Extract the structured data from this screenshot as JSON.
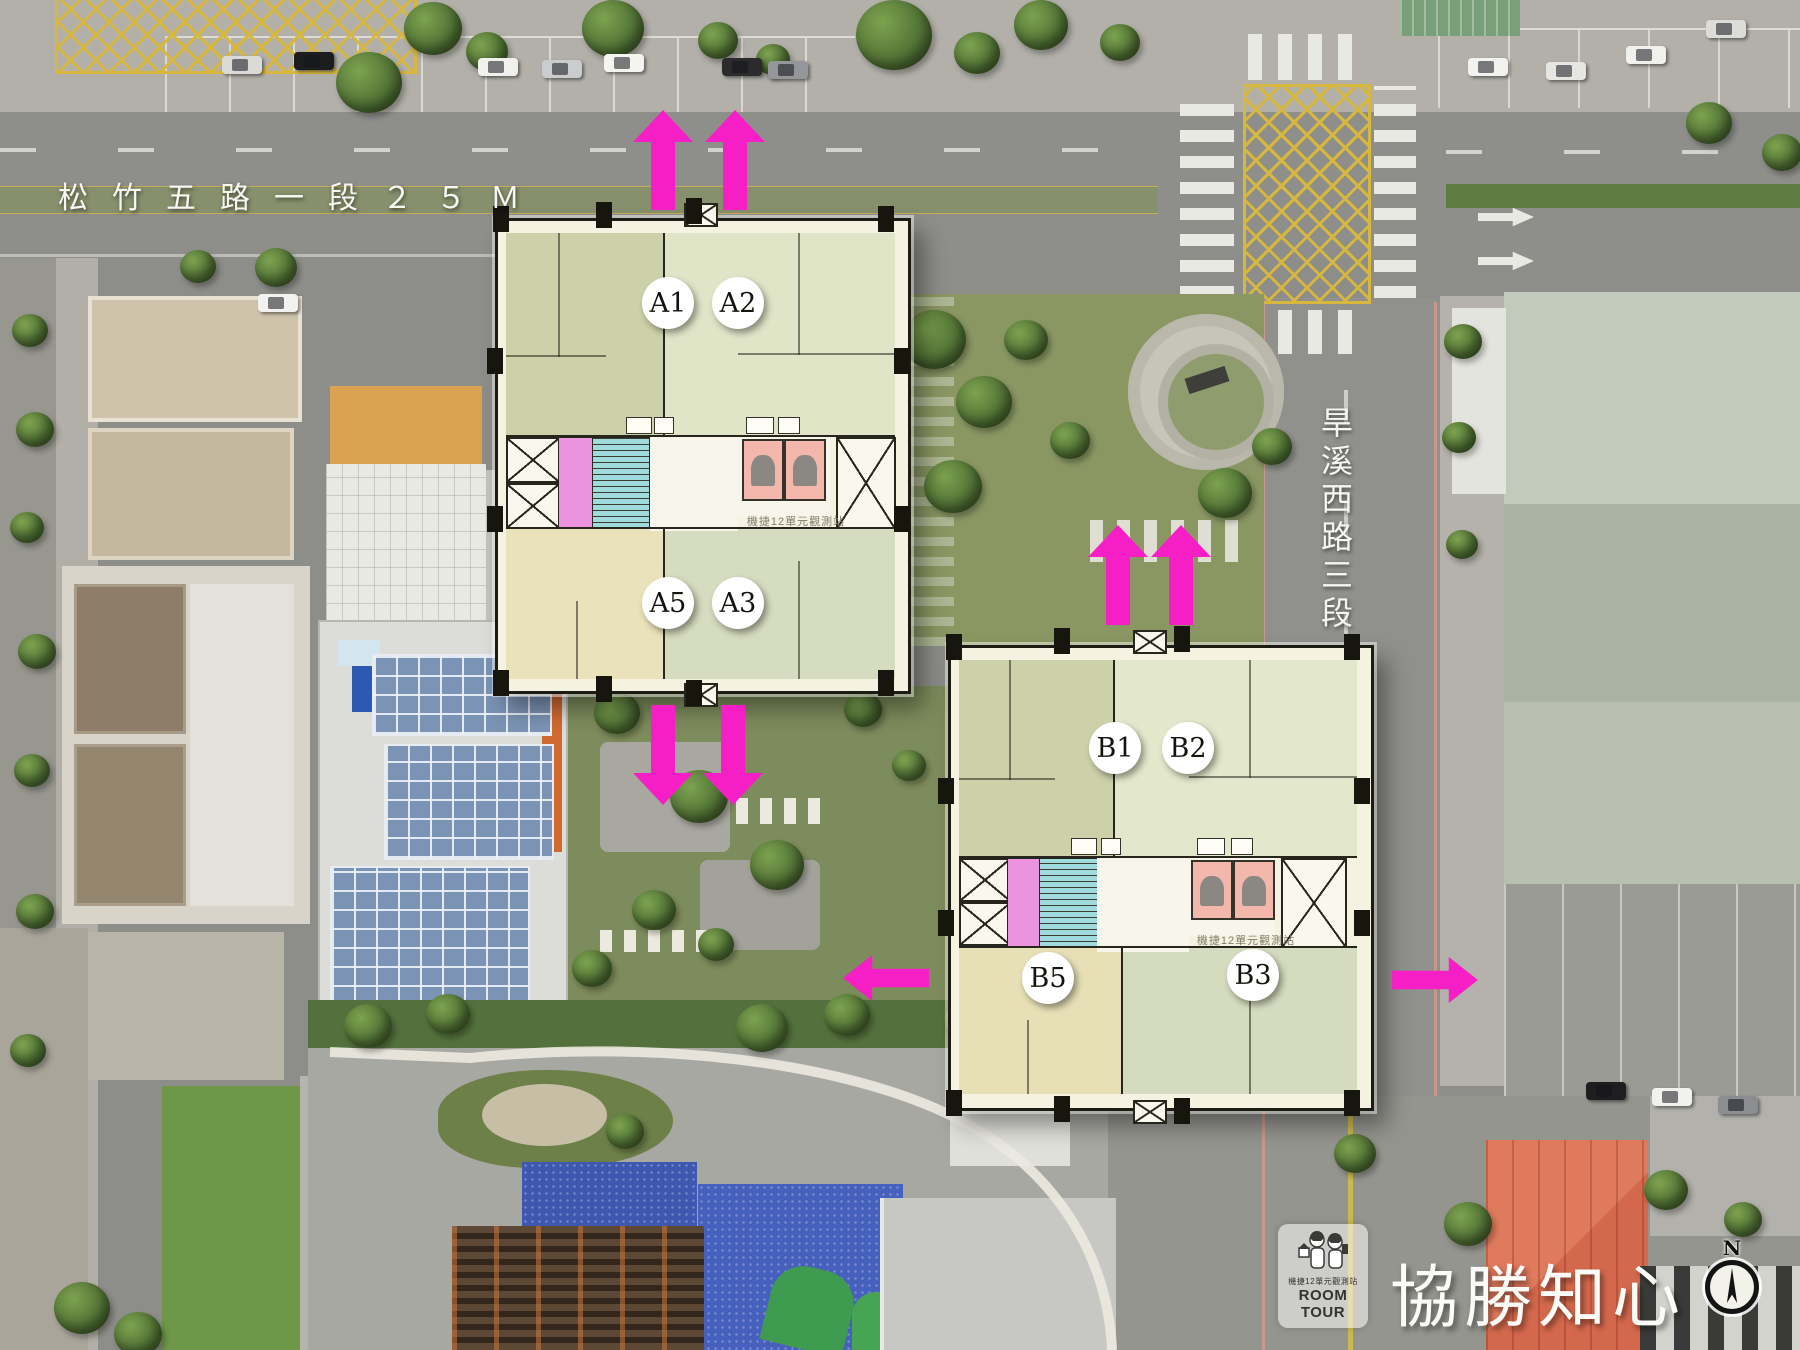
{
  "scene": {
    "description": "aerial drone photo site plan with overlaid floor plans",
    "north_label": "N"
  },
  "streets": {
    "songzhu": "松竹五路一段２５Ｍ",
    "hanxi": "旱溪西路三段"
  },
  "building_a": {
    "units": {
      "a1": "A1",
      "a2": "A2",
      "a5": "A5",
      "a3": "A3"
    },
    "watermark": "機捷12單元觀測站"
  },
  "building_b": {
    "units": {
      "b1": "B1",
      "b2": "B2",
      "b5": "B5",
      "b3": "B3"
    },
    "watermark": "機捷12單元觀測站"
  },
  "branding": {
    "title": "協勝知心",
    "badge_name": "機捷12單元觀測站",
    "badge_brand": "ROOM TOUR"
  },
  "compass": {
    "label": "N"
  },
  "colors": {
    "arrow_magenta": "#f61fc6",
    "hatch_yellow": "#d7b73e",
    "plan_olive": "#cdd1a9",
    "plan_pale_sage": "#e0e5c8",
    "plan_cream": "#e9e2ba",
    "plan_sage": "#d6dcbf",
    "core_pink": "#eb93df",
    "core_cyan": "#9fdbdd",
    "elevator_pink": "#f3b7ab"
  }
}
